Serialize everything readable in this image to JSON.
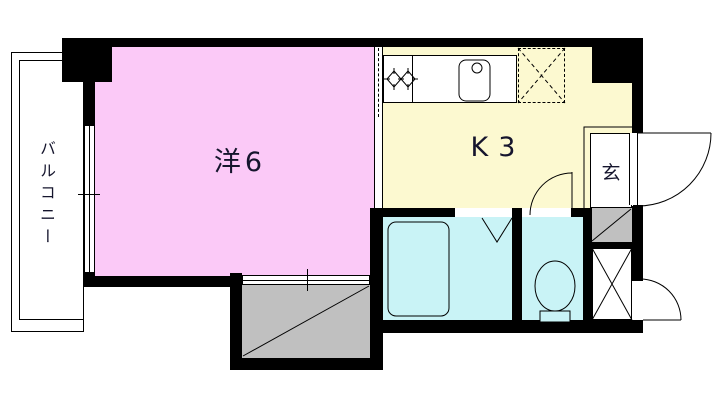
{
  "floorplan": {
    "rooms": {
      "balcony": {
        "label": "バルコニー"
      },
      "western_room": {
        "label": "洋6"
      },
      "kitchen": {
        "label": "K3"
      },
      "entrance": {
        "label": "玄"
      }
    },
    "colors": {
      "western_room": "#fbc9f7",
      "kitchen": "#fcf9d0",
      "wet_rooms": "#c9f3f6",
      "storage": "#c0c0c0",
      "walls": "#000000",
      "background": "#ffffff",
      "label_text": "#15152d"
    },
    "fixtures": [
      "bathtub",
      "toilet",
      "kitchen-sink",
      "stove-burners",
      "refrigerator-space",
      "entrance-door",
      "meter-box-door",
      "toilet-door",
      "folding-bath-door",
      "sliding-door",
      "window",
      "closet",
      "shoe-storage",
      "pipe-space"
    ]
  }
}
